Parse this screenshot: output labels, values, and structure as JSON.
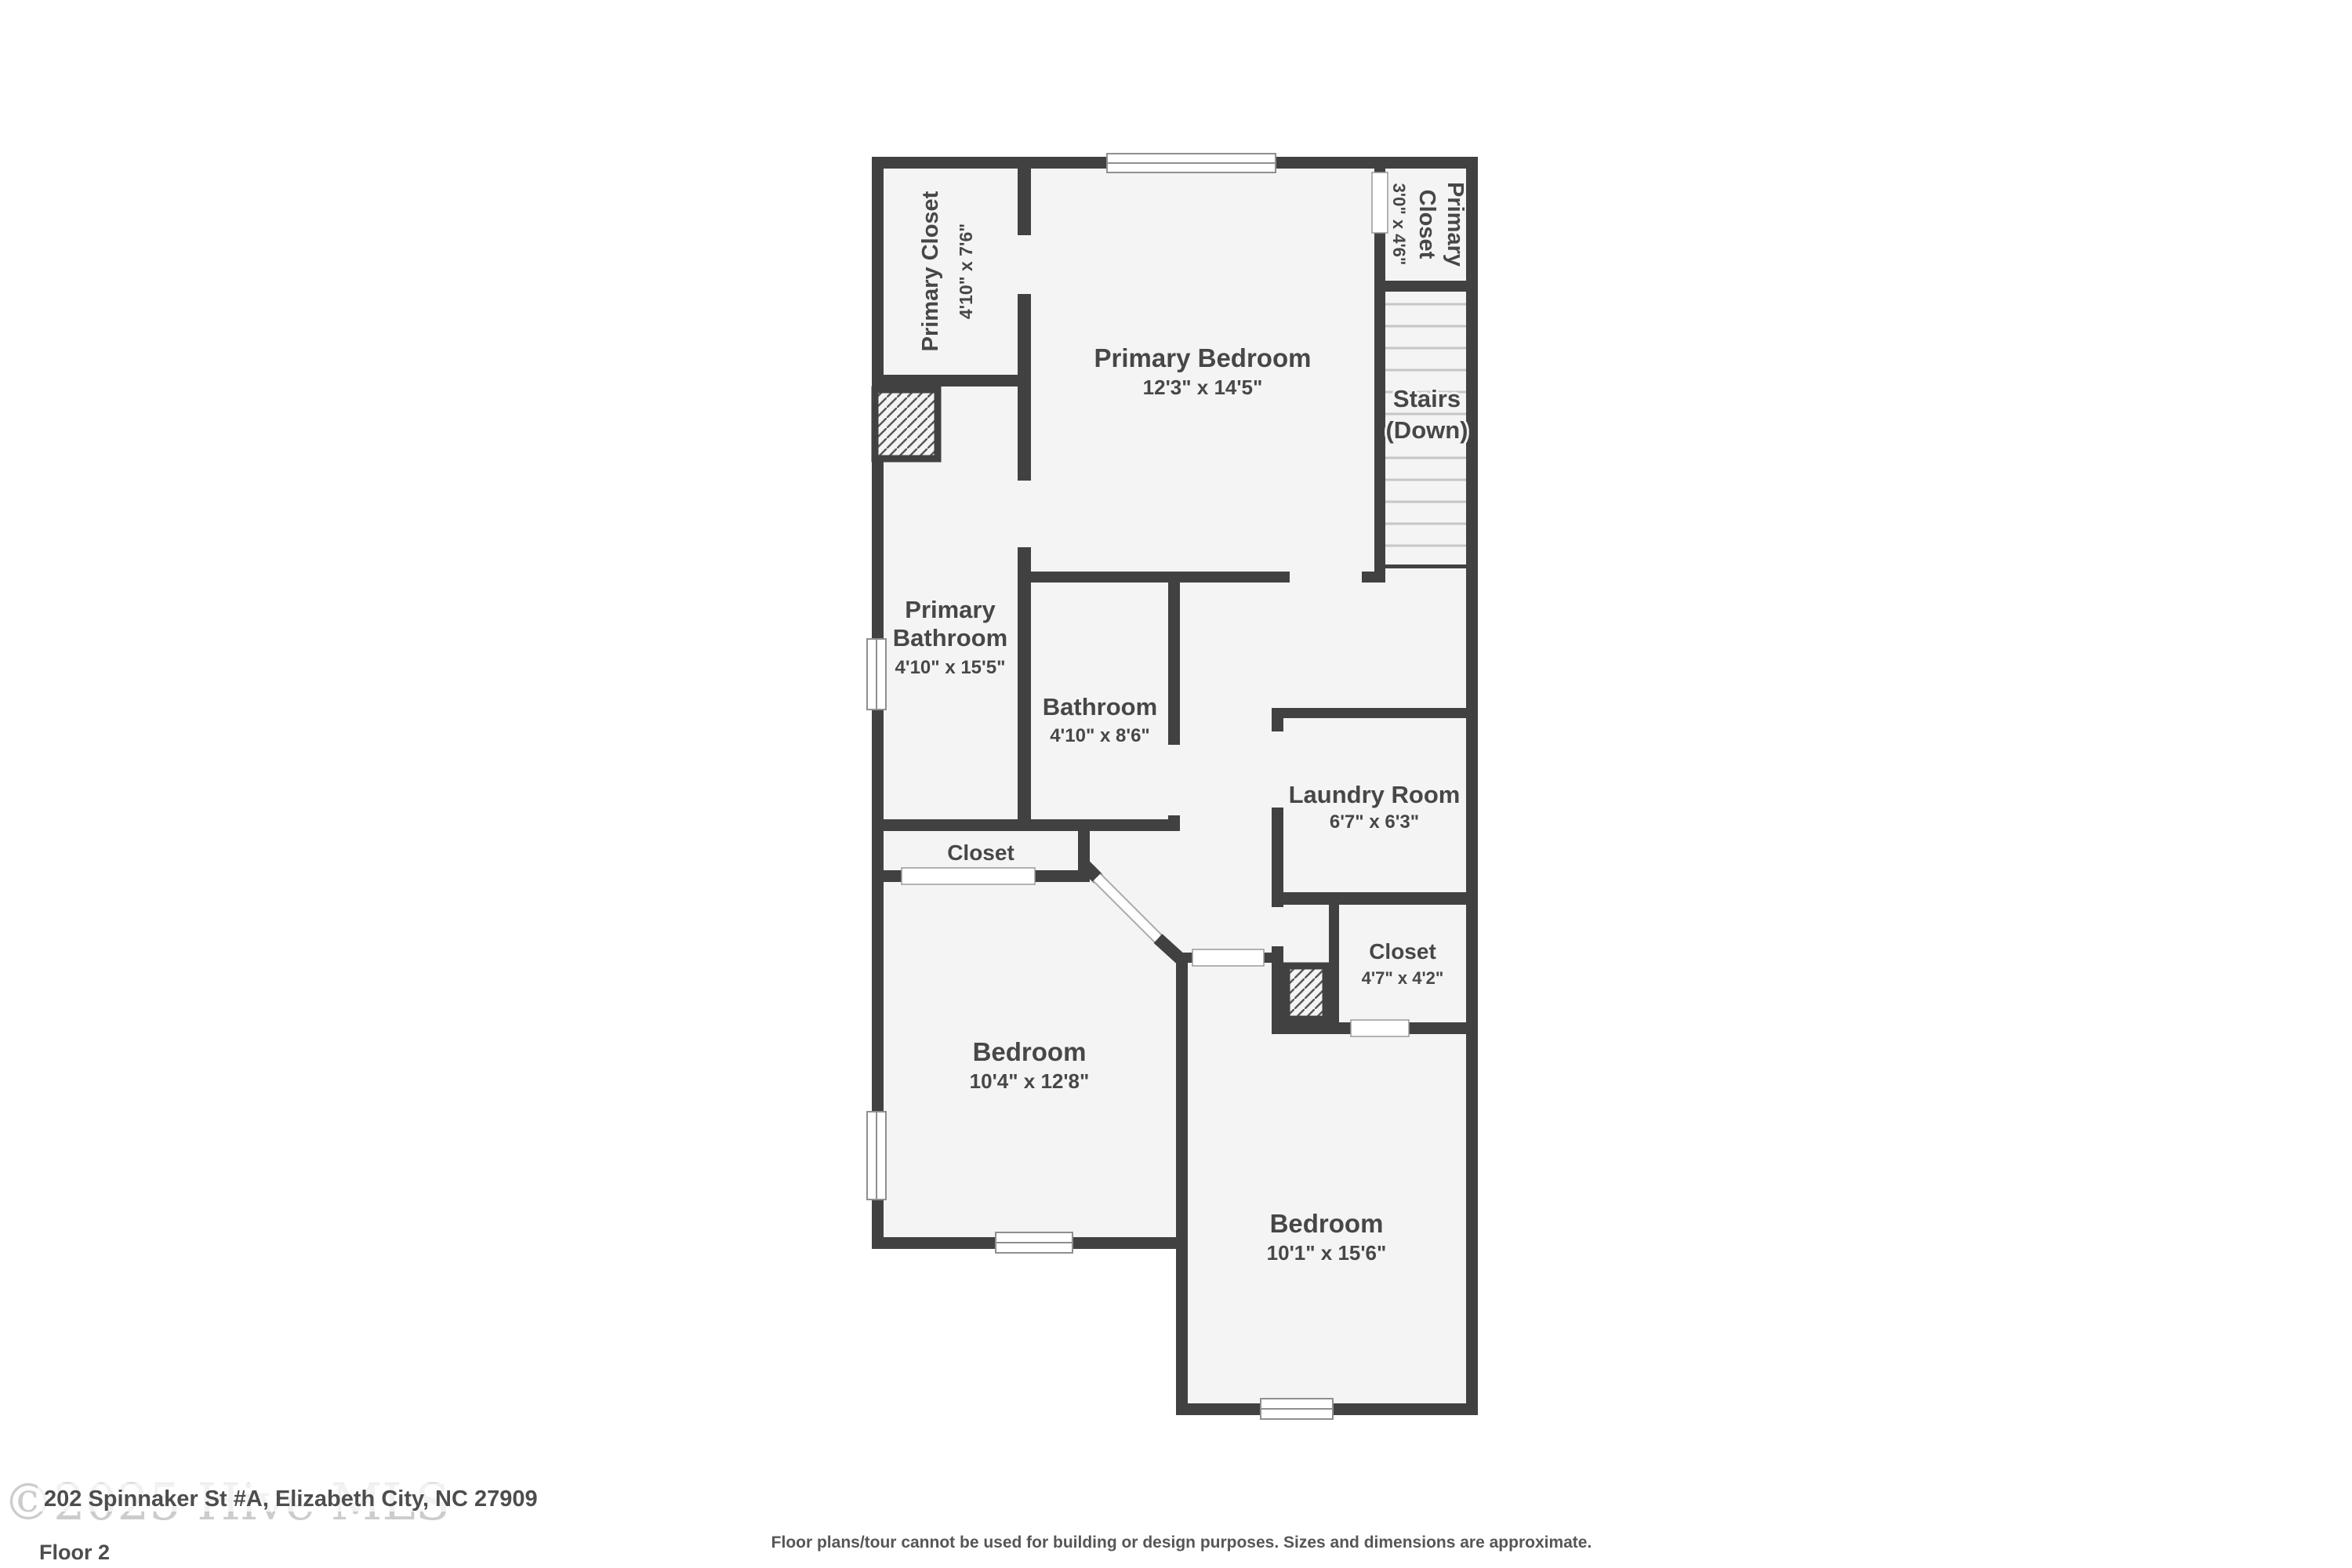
{
  "floorplan": {
    "rooms": [
      {
        "id": "primary-closet-left",
        "name": "Primary Closet",
        "dims": "4'10\" x 7'6\""
      },
      {
        "id": "primary-bedroom",
        "name": "Primary Bedroom",
        "dims": "12'3\" x 14'5\""
      },
      {
        "id": "primary-closet-right",
        "name_line1": "Primary",
        "name_line2": "Closet",
        "dims": "3'0\" x 4'6\""
      },
      {
        "id": "primary-bathroom",
        "name_line1": "Primary",
        "name_line2": "Bathroom",
        "dims": "4'10\" x 15'5\""
      },
      {
        "id": "bathroom",
        "name": "Bathroom",
        "dims": "4'10\" x 8'6\""
      },
      {
        "id": "laundry-room",
        "name": "Laundry Room",
        "dims": "6'7\" x 6'3\""
      },
      {
        "id": "closet-hall",
        "name": "Closet"
      },
      {
        "id": "closet-bedroom2",
        "name": "Closet",
        "dims": "4'7\" x 4'2\""
      },
      {
        "id": "bedroom-1",
        "name": "Bedroom",
        "dims": "10'4\" x 12'8\""
      },
      {
        "id": "bedroom-2",
        "name": "Bedroom",
        "dims": "10'1\" x 15'6\""
      }
    ],
    "stairs": {
      "line1": "Stairs",
      "line2": "(Down)"
    },
    "footer": {
      "watermark": "©2025 Hive MLS",
      "address": "202 Spinnaker St #A, Elizabeth City, NC 27909",
      "floor_label": "Floor 2",
      "disclaimer": "Floor plans/tour cannot be used for building or design purposes. Sizes and dimensions are approximate."
    },
    "colors": {
      "wall": "#414141",
      "room_fill": "#f4f4f4",
      "label": "#474747",
      "watermark": "#cccccc",
      "step_line": "#c6c6c6"
    }
  }
}
